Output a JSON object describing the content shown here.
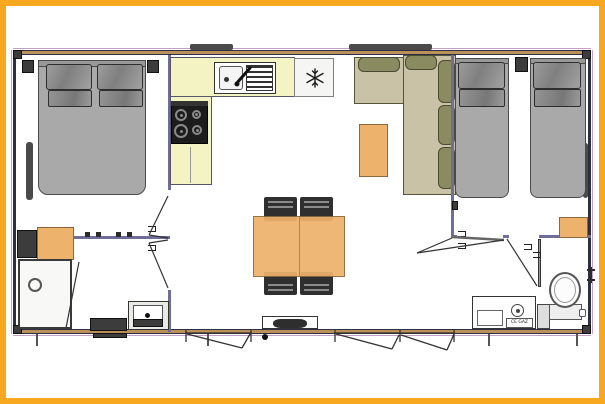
{
  "scene": {
    "description": "2D floor plan of a two-bedroom mobile home: master bedroom with double bed (left), kitchen with sink, drainer, 4-burner hob and fridge (top centre), L-shaped sofa with coffee table and dining table with four chairs (centre), twin bedroom with two single beds (right), shower room with washbasin (bottom left), WC with toilet and vanity (bottom right), central entrance step on the bottom wall flanked by two opening windows."
  },
  "labels": {
    "water_heater": "CE GAZ"
  },
  "icons": {
    "fridge_icon": "snowflake"
  },
  "colors": {
    "frame": "#F7A81E",
    "paper": "#FFFFFF",
    "wallExt": "#BB9058",
    "wallEdge": "#2E2E44",
    "wallInt": "#6E6E99",
    "bed": "#A9A9A9",
    "bedBorder": "#4A4A4A",
    "pillow": "#8F8F8F",
    "counter": "#F4F3C4",
    "counterBorder": "#55556E",
    "stove": "#1C1C1C",
    "burner": "#8A8A8A",
    "appliance": "#F5F5F3",
    "applianceBorder": "#808080",
    "sofaSeat": "#C9C2A6",
    "sofaBack": "#8B8B62",
    "sofaBorder": "#55553A",
    "wood": "#EDB26B",
    "woodBorder": "#8A6A3C",
    "chair": "#2F2F2F",
    "darkItem": "#3C3C3C",
    "line": "#333333",
    "windowStrip": "#4A4A4A"
  },
  "inventory": [
    "double-bed",
    "twin-bed",
    "twin-bed",
    "wardrobe",
    "shower",
    "washbasin",
    "kitchen-sink",
    "drainer",
    "gas-hob",
    "fridge",
    "corner-sofa",
    "coffee-table",
    "dining-table",
    "chair",
    "chair",
    "chair",
    "chair",
    "toilet",
    "vanity-unit",
    "gas-water-heater",
    "bedside-cabinet",
    "entrance-step"
  ]
}
